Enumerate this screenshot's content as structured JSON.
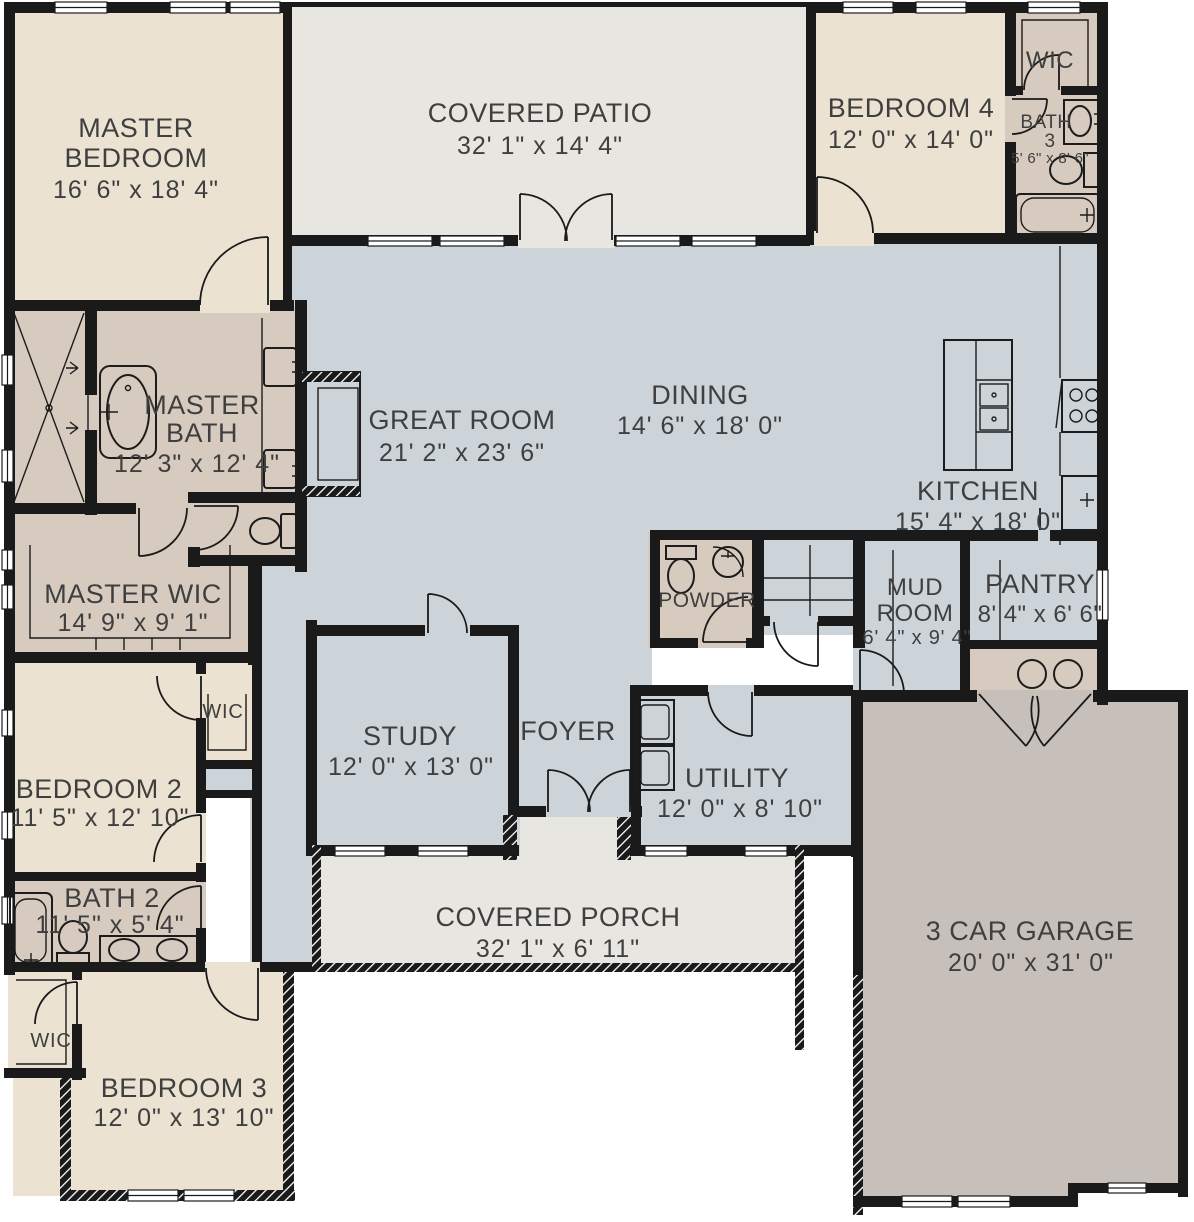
{
  "plan_title": "Single-story house floor plan",
  "colors": {
    "wall": "#1a1a1a",
    "living_floor": "#ccd3d9",
    "bedroom_floor": "#ebe2d2",
    "bath_floor": "#d7cbc0",
    "outdoor_floor": "#e8e6e1",
    "garage_floor": "#c6bfba",
    "label_text": "#3f3f3f"
  },
  "rooms": {
    "master_bedroom": {
      "l1": "MASTER",
      "l2": "BEDROOM",
      "dims": "16' 6\" x 18' 4\""
    },
    "covered_patio": {
      "l1": "COVERED PATIO",
      "dims": "32' 1\" x 14' 4\""
    },
    "bedroom4": {
      "l1": "BEDROOM 4",
      "dims": "12' 0\" x 14' 0\""
    },
    "wic_top": {
      "l1": "WIC"
    },
    "bath3": {
      "l1": "BATH",
      "l2": "3",
      "dims": "5' 6\" x 8' 6\""
    },
    "master_bath": {
      "l1": "MASTER",
      "l2": "BATH",
      "dims": "12' 3\" x 12' 4\""
    },
    "master_wic": {
      "l1": "MASTER WIC",
      "dims": "14' 9\" x 9' 1\""
    },
    "great_room": {
      "l1": "GREAT ROOM",
      "dims": "21' 2\" x 23' 6\""
    },
    "dining": {
      "l1": "DINING",
      "dims": "14' 6\" x 18' 0\""
    },
    "kitchen": {
      "l1": "KITCHEN",
      "dims": "15' 4\" x 18' 0\""
    },
    "powder": {
      "l1": "POWDER"
    },
    "mud_room": {
      "l1": "MUD",
      "l2": "ROOM",
      "dims": "6' 4\" x 9' 4\""
    },
    "pantry": {
      "l1": "PANTRY",
      "dims": "8' 4\" x 6' 6\""
    },
    "wic_b2": {
      "l1": "WIC"
    },
    "bedroom2": {
      "l1": "BEDROOM 2",
      "dims": "11' 5\" x 12' 10\""
    },
    "bath2": {
      "l1": "BATH 2",
      "dims": "11' 5\" x 5' 4\""
    },
    "wic_b3": {
      "l1": "WIC"
    },
    "bedroom3": {
      "l1": "BEDROOM 3",
      "dims": "12' 0\" x 13' 10\""
    },
    "study": {
      "l1": "STUDY",
      "dims": "12' 0\" x 13' 0\""
    },
    "foyer": {
      "l1": "FOYER"
    },
    "utility": {
      "l1": "UTILITY",
      "dims": "12' 0\" x 8' 10\""
    },
    "covered_porch": {
      "l1": "COVERED PORCH",
      "dims": "32' 1\" x 6' 11\""
    },
    "garage": {
      "l1": "3 CAR GARAGE",
      "dims": "20' 0\" x 31' 0\""
    }
  }
}
